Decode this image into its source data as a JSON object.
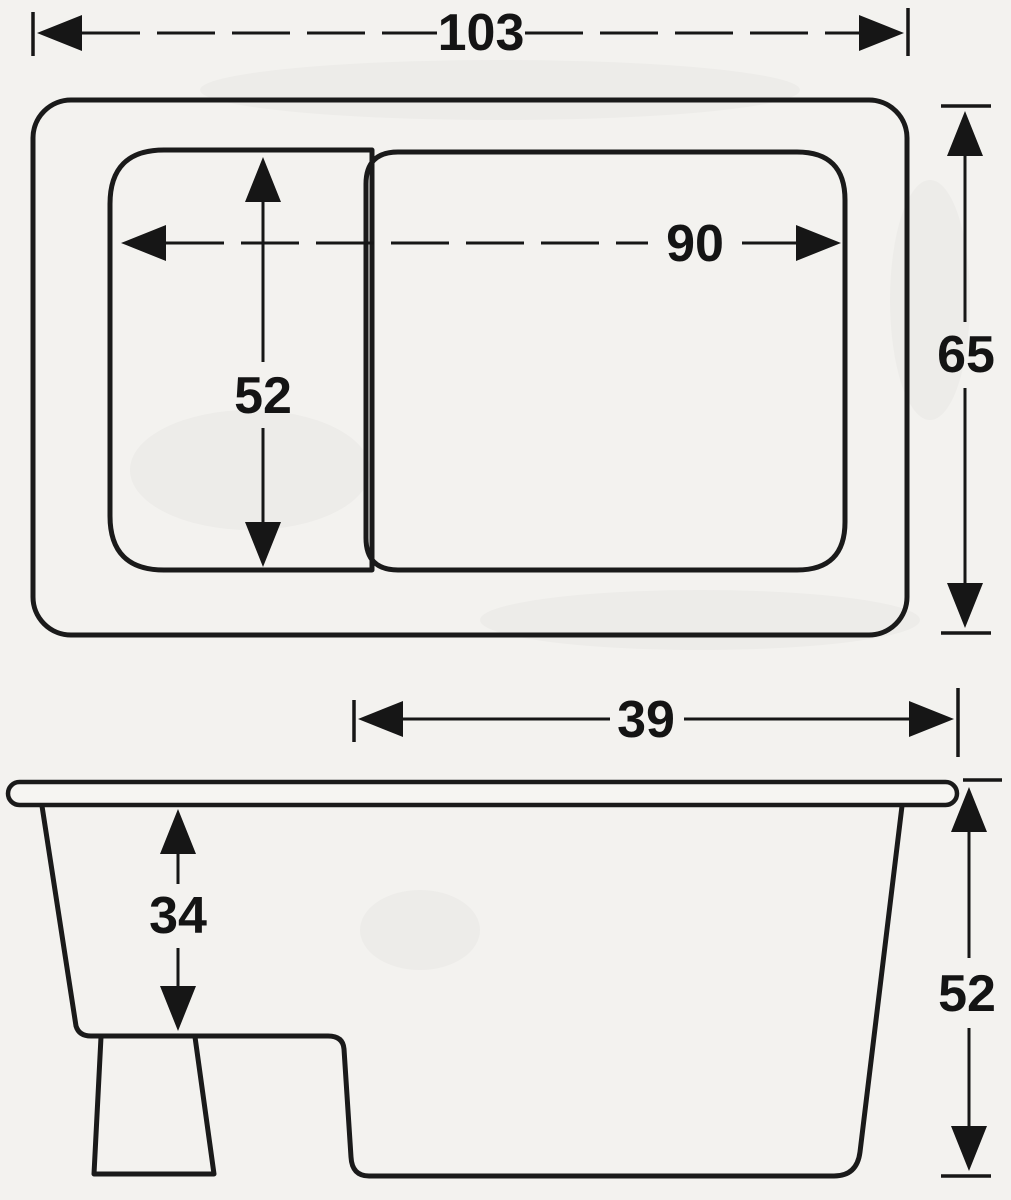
{
  "page": {
    "background_color": "#f3f2ef",
    "ink_color": "#1a1a1a"
  },
  "dims": {
    "plan_overall_length": "103",
    "plan_overall_width": "65",
    "plan_basin_length": "90",
    "plan_basin_width": "52",
    "side_well_length": "39",
    "side_seat_depth": "34",
    "side_overall_height": "52"
  }
}
